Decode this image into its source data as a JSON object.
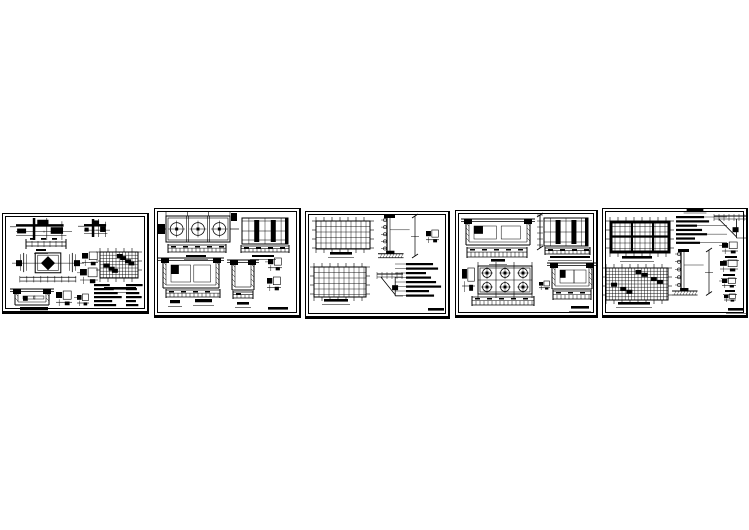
{
  "canvas": {
    "width": 749,
    "height": 530,
    "background": "#ffffff"
  },
  "colors": {
    "ink": "#000000",
    "paper": "#ffffff"
  },
  "sheets": [
    {
      "id": "1",
      "frame": {
        "x": 2,
        "y": 213,
        "w": 147,
        "h": 101
      },
      "figures": [
        {
          "t": "joint_cluster",
          "x": 16,
          "y": 218,
          "w": 56,
          "h": 22
        },
        {
          "t": "joint_cluster",
          "x": 84,
          "y": 219,
          "w": 26,
          "h": 18
        },
        {
          "t": "dim_h",
          "x": 26,
          "y": 241,
          "w": 40,
          "h": 6
        },
        {
          "t": "label",
          "x": 36,
          "y": 249,
          "w": 10,
          "h": 3
        },
        {
          "t": "diamond_plan",
          "x": 16,
          "y": 251,
          "w": 64,
          "h": 32
        },
        {
          "t": "glyph",
          "x": 82,
          "y": 252,
          "w": 16,
          "h": 14
        },
        {
          "t": "glyph",
          "x": 80,
          "y": 268,
          "w": 18,
          "h": 16
        },
        {
          "t": "plan_grid",
          "x": 100,
          "y": 252,
          "w": 38,
          "h": 26,
          "p": {
            "dense": true,
            "ticks": true
          }
        },
        {
          "t": "label",
          "x": 104,
          "y": 287,
          "w": 32,
          "h": 4
        },
        {
          "t": "section_u",
          "x": 15,
          "y": 289,
          "w": 34,
          "h": 16
        },
        {
          "t": "label",
          "x": 20,
          "y": 307,
          "w": 28,
          "h": 5
        },
        {
          "t": "glyph",
          "x": 56,
          "y": 291,
          "w": 16,
          "h": 15
        },
        {
          "t": "glyph",
          "x": 77,
          "y": 294,
          "w": 12,
          "h": 12
        },
        {
          "t": "notes",
          "x": 94,
          "y": 284,
          "w": 30,
          "h": 24,
          "p": {
            "rows": 6
          }
        },
        {
          "t": "notes",
          "x": 126,
          "y": 284,
          "w": 18,
          "h": 24,
          "p": {
            "rows": 6
          }
        }
      ]
    },
    {
      "id": "2",
      "frame": {
        "x": 154,
        "y": 208,
        "w": 147,
        "h": 110
      },
      "figures": [
        {
          "t": "plan_cells",
          "x": 166,
          "y": 216,
          "w": 64,
          "h": 26,
          "p": {
            "cells": 3
          }
        },
        {
          "t": "base_strip",
          "x": 168,
          "y": 245,
          "w": 58,
          "h": 7
        },
        {
          "t": "label",
          "x": 186,
          "y": 255,
          "w": 20,
          "h": 3
        },
        {
          "t": "elevation",
          "x": 242,
          "y": 218,
          "w": 46,
          "h": 26,
          "p": {
            "cols": 2
          }
        },
        {
          "t": "base_strip",
          "x": 241,
          "y": 246,
          "w": 48,
          "h": 6
        },
        {
          "t": "label",
          "x": 252,
          "y": 255,
          "w": 22,
          "h": 3
        },
        {
          "t": "section_u",
          "x": 163,
          "y": 258,
          "w": 56,
          "h": 30
        },
        {
          "t": "base_strip",
          "x": 166,
          "y": 290,
          "w": 54,
          "h": 7
        },
        {
          "t": "label",
          "x": 170,
          "y": 300,
          "w": 10,
          "h": 5
        },
        {
          "t": "label",
          "x": 195,
          "y": 299,
          "w": 17,
          "h": 5
        },
        {
          "t": "section_u",
          "x": 232,
          "y": 260,
          "w": 22,
          "h": 30
        },
        {
          "t": "base_strip",
          "x": 233,
          "y": 292,
          "w": 20,
          "h": 6
        },
        {
          "t": "label",
          "x": 237,
          "y": 302,
          "w": 12,
          "h": 4
        },
        {
          "t": "glyph",
          "x": 268,
          "y": 258,
          "w": 14,
          "h": 13
        },
        {
          "t": "glyph",
          "x": 267,
          "y": 277,
          "w": 14,
          "h": 14
        },
        {
          "t": "label",
          "x": 268,
          "y": 307,
          "w": 20,
          "h": 4
        }
      ]
    },
    {
      "id": "3",
      "frame": {
        "x": 305,
        "y": 211,
        "w": 145,
        "h": 108
      },
      "figures": [
        {
          "t": "plan_grid",
          "x": 316,
          "y": 221,
          "w": 54,
          "h": 28,
          "p": {
            "ticks": true
          }
        },
        {
          "t": "label",
          "x": 330,
          "y": 252,
          "w": 22,
          "h": 4
        },
        {
          "t": "cwall",
          "x": 380,
          "y": 216,
          "w": 38,
          "h": 46
        },
        {
          "t": "glyph",
          "x": 426,
          "y": 230,
          "w": 13,
          "h": 13
        },
        {
          "t": "plan_grid",
          "x": 314,
          "y": 267,
          "w": 52,
          "h": 30,
          "p": {
            "ticks": true
          }
        },
        {
          "t": "label",
          "x": 324,
          "y": 299,
          "w": 24,
          "h": 4
        },
        {
          "t": "truss",
          "x": 377,
          "y": 272,
          "w": 26,
          "h": 24
        },
        {
          "t": "notes",
          "x": 406,
          "y": 263,
          "w": 38,
          "h": 36,
          "p": {
            "rows": 8,
            "leaders": "left"
          }
        },
        {
          "t": "label",
          "x": 428,
          "y": 308,
          "w": 16,
          "h": 4
        }
      ]
    },
    {
      "id": "4",
      "frame": {
        "x": 455,
        "y": 210,
        "w": 143,
        "h": 108
      },
      "figures": [
        {
          "t": "section_u",
          "x": 466,
          "y": 219,
          "w": 64,
          "h": 26
        },
        {
          "t": "base_strip",
          "x": 467,
          "y": 248,
          "w": 60,
          "h": 9
        },
        {
          "t": "label",
          "x": 491,
          "y": 259,
          "w": 14,
          "h": 4
        },
        {
          "t": "axis_v",
          "x": 538,
          "y": 215,
          "w": 4,
          "h": 33
        },
        {
          "t": "elevation",
          "x": 544,
          "y": 218,
          "w": 44,
          "h": 28,
          "p": {
            "cols": 2
          }
        },
        {
          "t": "base_strip",
          "x": 545,
          "y": 248,
          "w": 45,
          "h": 6
        },
        {
          "t": "label",
          "x": 550,
          "y": 256,
          "w": 40,
          "h": 3
        },
        {
          "t": "glyph",
          "x": 462,
          "y": 268,
          "w": 13,
          "h": 24
        },
        {
          "t": "plan_circles",
          "x": 478,
          "y": 266,
          "w": 54,
          "h": 28,
          "p": {
            "rows": 2,
            "cols": 3
          }
        },
        {
          "t": "base_strip",
          "x": 472,
          "y": 297,
          "w": 62,
          "h": 8
        },
        {
          "t": "glyph",
          "x": 539,
          "y": 281,
          "w": 11,
          "h": 9
        },
        {
          "t": "section_u",
          "x": 552,
          "y": 263,
          "w": 40,
          "h": 26
        },
        {
          "t": "base_strip",
          "x": 553,
          "y": 291,
          "w": 38,
          "h": 8
        },
        {
          "t": "label",
          "x": 571,
          "y": 306,
          "w": 18,
          "h": 4
        }
      ]
    },
    {
      "id": "5",
      "frame": {
        "x": 602,
        "y": 208,
        "w": 146,
        "h": 110
      },
      "figures": [
        {
          "t": "plan_grid",
          "x": 610,
          "y": 221,
          "w": 60,
          "h": 32,
          "p": {
            "ticks": true,
            "edges": true
          }
        },
        {
          "t": "label",
          "x": 622,
          "y": 256,
          "w": 30,
          "h": 4
        },
        {
          "t": "plan_grid",
          "x": 606,
          "y": 268,
          "w": 62,
          "h": 32,
          "p": {
            "dense": true,
            "ticks": true
          }
        },
        {
          "t": "label",
          "x": 618,
          "y": 302,
          "w": 32,
          "h": 4
        },
        {
          "t": "notes",
          "x": 676,
          "y": 216,
          "w": 38,
          "h": 30,
          "p": {
            "rows": 7,
            "leaders": "right",
            "title": true
          }
        },
        {
          "t": "cwall",
          "x": 674,
          "y": 250,
          "w": 38,
          "h": 50
        },
        {
          "t": "truss",
          "x": 714,
          "y": 214,
          "w": 32,
          "h": 24
        },
        {
          "t": "glyph",
          "x": 722,
          "y": 242,
          "w": 16,
          "h": 12
        },
        {
          "t": "label",
          "x": 725,
          "y": 256,
          "w": 12,
          "h": 3
        },
        {
          "t": "glyph",
          "x": 720,
          "y": 260,
          "w": 18,
          "h": 12
        },
        {
          "t": "label",
          "x": 723,
          "y": 274,
          "w": 12,
          "h": 3
        },
        {
          "t": "glyph",
          "x": 722,
          "y": 278,
          "w": 14,
          "h": 10
        },
        {
          "t": "label",
          "x": 725,
          "y": 290,
          "w": 10,
          "h": 3
        },
        {
          "t": "glyph",
          "x": 724,
          "y": 294,
          "w": 12,
          "h": 8
        },
        {
          "t": "label",
          "x": 728,
          "y": 308,
          "w": 16,
          "h": 4
        }
      ]
    }
  ]
}
